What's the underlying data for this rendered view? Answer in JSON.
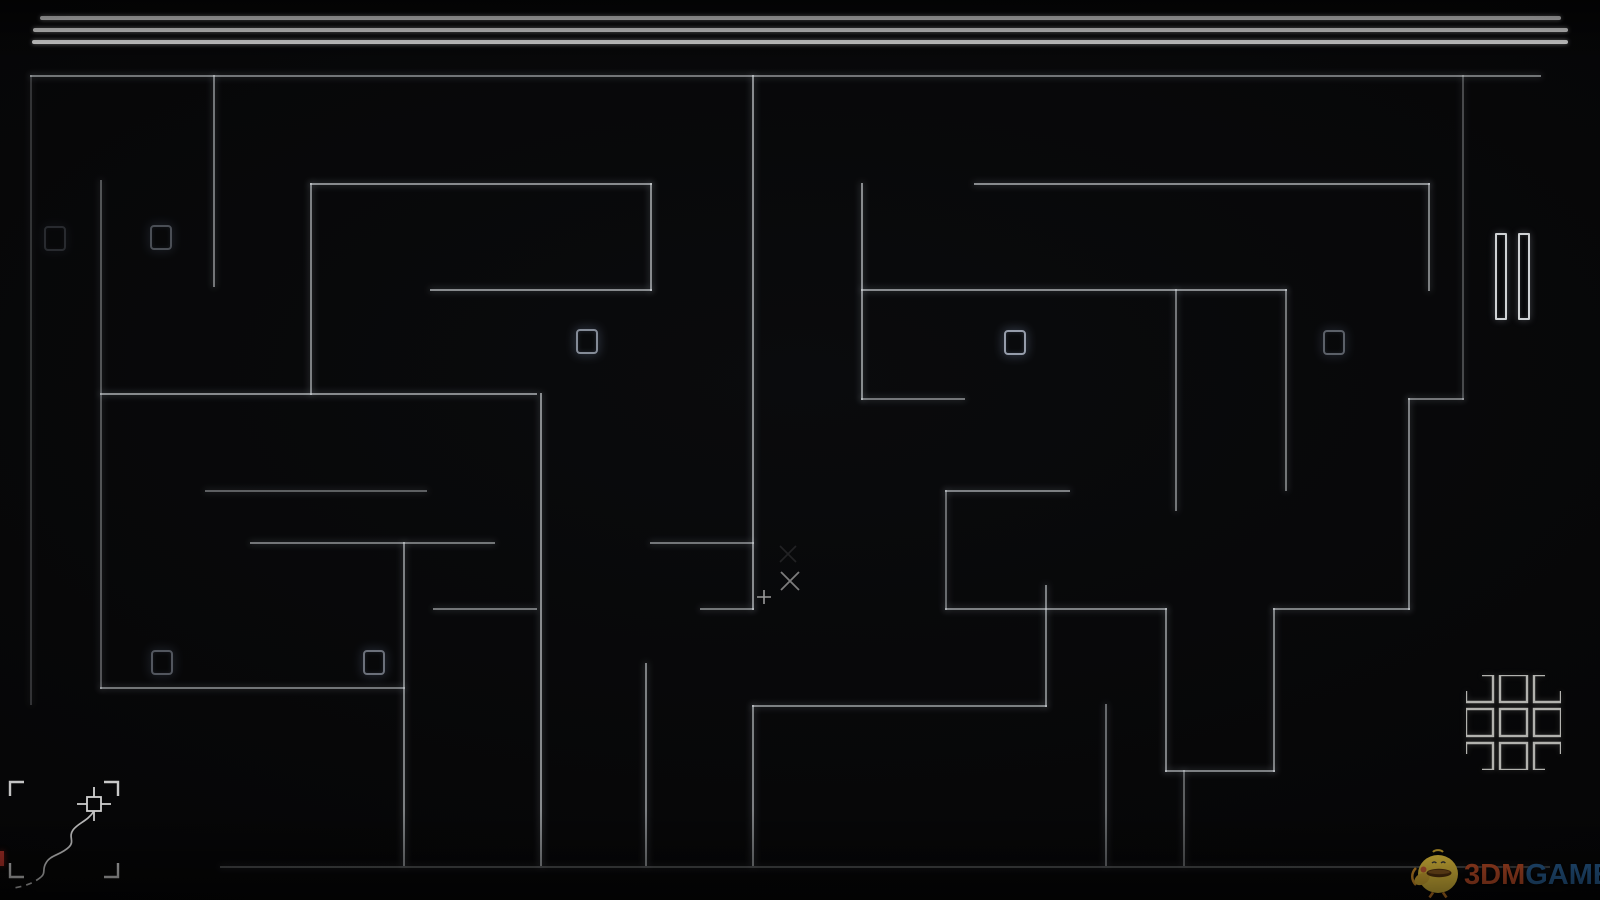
{
  "meta": {
    "app": "minimal maze game",
    "background_color": "#060607",
    "wall_color": "#dde2e6",
    "square_color": "#aeb6c6",
    "header_line_color": "#d8d8d8",
    "red_tick_color": "#b03028"
  },
  "header": {
    "lines": [
      {
        "x": 40,
        "y": 16,
        "w": 1521
      },
      {
        "x": 33,
        "y": 28,
        "w": 1535
      },
      {
        "x": 32,
        "y": 40,
        "w": 1536
      }
    ]
  },
  "maze": {
    "walls": [
      {
        "x": 30,
        "y": 75,
        "w": 1511,
        "h": 2,
        "o": 0.5
      },
      {
        "x": 30,
        "y": 75,
        "w": 2,
        "h": 630,
        "o": 0.2
      },
      {
        "x": 1462,
        "y": 75,
        "w": 2,
        "h": 325,
        "o": 0.3
      },
      {
        "x": 220,
        "y": 866,
        "w": 1330,
        "h": 2,
        "o": 0.3
      },
      {
        "x": 213,
        "y": 75,
        "w": 2,
        "h": 212,
        "o": 0.5
      },
      {
        "x": 100,
        "y": 180,
        "w": 2,
        "h": 509,
        "o": 0.35
      },
      {
        "x": 310,
        "y": 183,
        "w": 2,
        "h": 212,
        "o": 0.55
      },
      {
        "x": 310,
        "y": 183,
        "w": 342,
        "h": 2,
        "o": 0.6
      },
      {
        "x": 650,
        "y": 183,
        "w": 2,
        "h": 108,
        "o": 0.6
      },
      {
        "x": 430,
        "y": 289,
        "w": 222,
        "h": 2,
        "o": 0.6
      },
      {
        "x": 100,
        "y": 393,
        "w": 437,
        "h": 2,
        "o": 0.6
      },
      {
        "x": 205,
        "y": 490,
        "w": 222,
        "h": 2,
        "o": 0.4
      },
      {
        "x": 540,
        "y": 393,
        "w": 2,
        "h": 473,
        "o": 0.6
      },
      {
        "x": 752,
        "y": 75,
        "w": 2,
        "h": 535,
        "o": 0.6
      },
      {
        "x": 433,
        "y": 608,
        "w": 104,
        "h": 2,
        "o": 0.5
      },
      {
        "x": 700,
        "y": 608,
        "w": 54,
        "h": 2,
        "o": 0.5
      },
      {
        "x": 250,
        "y": 542,
        "w": 245,
        "h": 2,
        "o": 0.5
      },
      {
        "x": 650,
        "y": 542,
        "w": 104,
        "h": 2,
        "o": 0.5
      },
      {
        "x": 403,
        "y": 542,
        "w": 2,
        "h": 324,
        "o": 0.55
      },
      {
        "x": 100,
        "y": 687,
        "w": 305,
        "h": 2,
        "o": 0.5
      },
      {
        "x": 645,
        "y": 663,
        "w": 2,
        "h": 203,
        "o": 0.55
      },
      {
        "x": 752,
        "y": 705,
        "w": 2,
        "h": 161,
        "o": 0.55
      },
      {
        "x": 752,
        "y": 705,
        "w": 295,
        "h": 2,
        "o": 0.55
      },
      {
        "x": 1045,
        "y": 585,
        "w": 2,
        "h": 122,
        "o": 0.55
      },
      {
        "x": 974,
        "y": 183,
        "w": 456,
        "h": 2,
        "o": 0.6
      },
      {
        "x": 1428,
        "y": 183,
        "w": 2,
        "h": 108,
        "o": 0.55
      },
      {
        "x": 861,
        "y": 183,
        "w": 2,
        "h": 217,
        "o": 0.6
      },
      {
        "x": 861,
        "y": 398,
        "w": 104,
        "h": 2,
        "o": 0.5
      },
      {
        "x": 861,
        "y": 289,
        "w": 426,
        "h": 2,
        "o": 0.6
      },
      {
        "x": 1175,
        "y": 289,
        "w": 2,
        "h": 222,
        "o": 0.5
      },
      {
        "x": 1285,
        "y": 289,
        "w": 2,
        "h": 202,
        "o": 0.5
      },
      {
        "x": 1408,
        "y": 398,
        "w": 56,
        "h": 2,
        "o": 0.5
      },
      {
        "x": 1408,
        "y": 398,
        "w": 2,
        "h": 212,
        "o": 0.55
      },
      {
        "x": 945,
        "y": 490,
        "w": 125,
        "h": 2,
        "o": 0.55
      },
      {
        "x": 945,
        "y": 490,
        "w": 2,
        "h": 120,
        "o": 0.45
      },
      {
        "x": 945,
        "y": 608,
        "w": 222,
        "h": 2,
        "o": 0.55
      },
      {
        "x": 1165,
        "y": 608,
        "w": 2,
        "h": 164,
        "o": 0.55
      },
      {
        "x": 1165,
        "y": 770,
        "w": 110,
        "h": 2,
        "o": 0.55
      },
      {
        "x": 1273,
        "y": 608,
        "w": 2,
        "h": 164,
        "o": 0.55
      },
      {
        "x": 1273,
        "y": 608,
        "w": 137,
        "h": 2,
        "o": 0.55
      },
      {
        "x": 1105,
        "y": 704,
        "w": 2,
        "h": 162,
        "o": 0.45
      },
      {
        "x": 1183,
        "y": 770,
        "w": 2,
        "h": 96,
        "o": 0.4
      }
    ],
    "squares": [
      {
        "x": 44,
        "y": 226,
        "o": 0.2
      },
      {
        "x": 150,
        "y": 225,
        "o": 0.4
      },
      {
        "x": 576,
        "y": 329,
        "o": 0.75
      },
      {
        "x": 1004,
        "y": 330,
        "o": 0.85
      },
      {
        "x": 1323,
        "y": 330,
        "o": 0.5
      },
      {
        "x": 151,
        "y": 650,
        "o": 0.45
      },
      {
        "x": 363,
        "y": 650,
        "o": 0.6
      }
    ]
  },
  "cursors": {
    "plus_d": "M15 8 V22 M8 15 H22",
    "x_d": "M3 3 L21 21 M21 3 L3 21",
    "ghost_x_d": "M3 3 L19 19 M19 3 L3 19"
  },
  "viewfinder": {
    "bracket_tl_d": "M10 41 V27 H24",
    "bracket_tr_d": "M104 27 H118 V41",
    "bracket_bl_d": "M10 108 V122 H24",
    "bracket_br_d": "M104 122 H118 V108",
    "marker_ticks_d": "M94 32 V42 M94 56 V66 M77 49 H87 M101 49 H111",
    "trail_solid_d": "M94 56 C88 66 78 68 73 75 C68 82 75 86 69 92 C61 100 50 100 46 108 C42 114 46 118 41 122",
    "trail_dashed_d": "M41 122 C34 128 25 131 14 133"
  },
  "grid_icon": {
    "corner_tl_d": "M16 0 H27 V27 H0 V16",
    "corner_tr_d": "M79 0 H68 V27 H95 V16",
    "corner_bl_d": "M16 95 H27 V68 H0 V79",
    "corner_br_d": "M79 95 H68 V68 H95 V79"
  },
  "watermark": {
    "brand_left": "3DM",
    "brand_right": "GAME",
    "brand_left_color": "#c44f28",
    "brand_right_color": "#2a639a"
  }
}
